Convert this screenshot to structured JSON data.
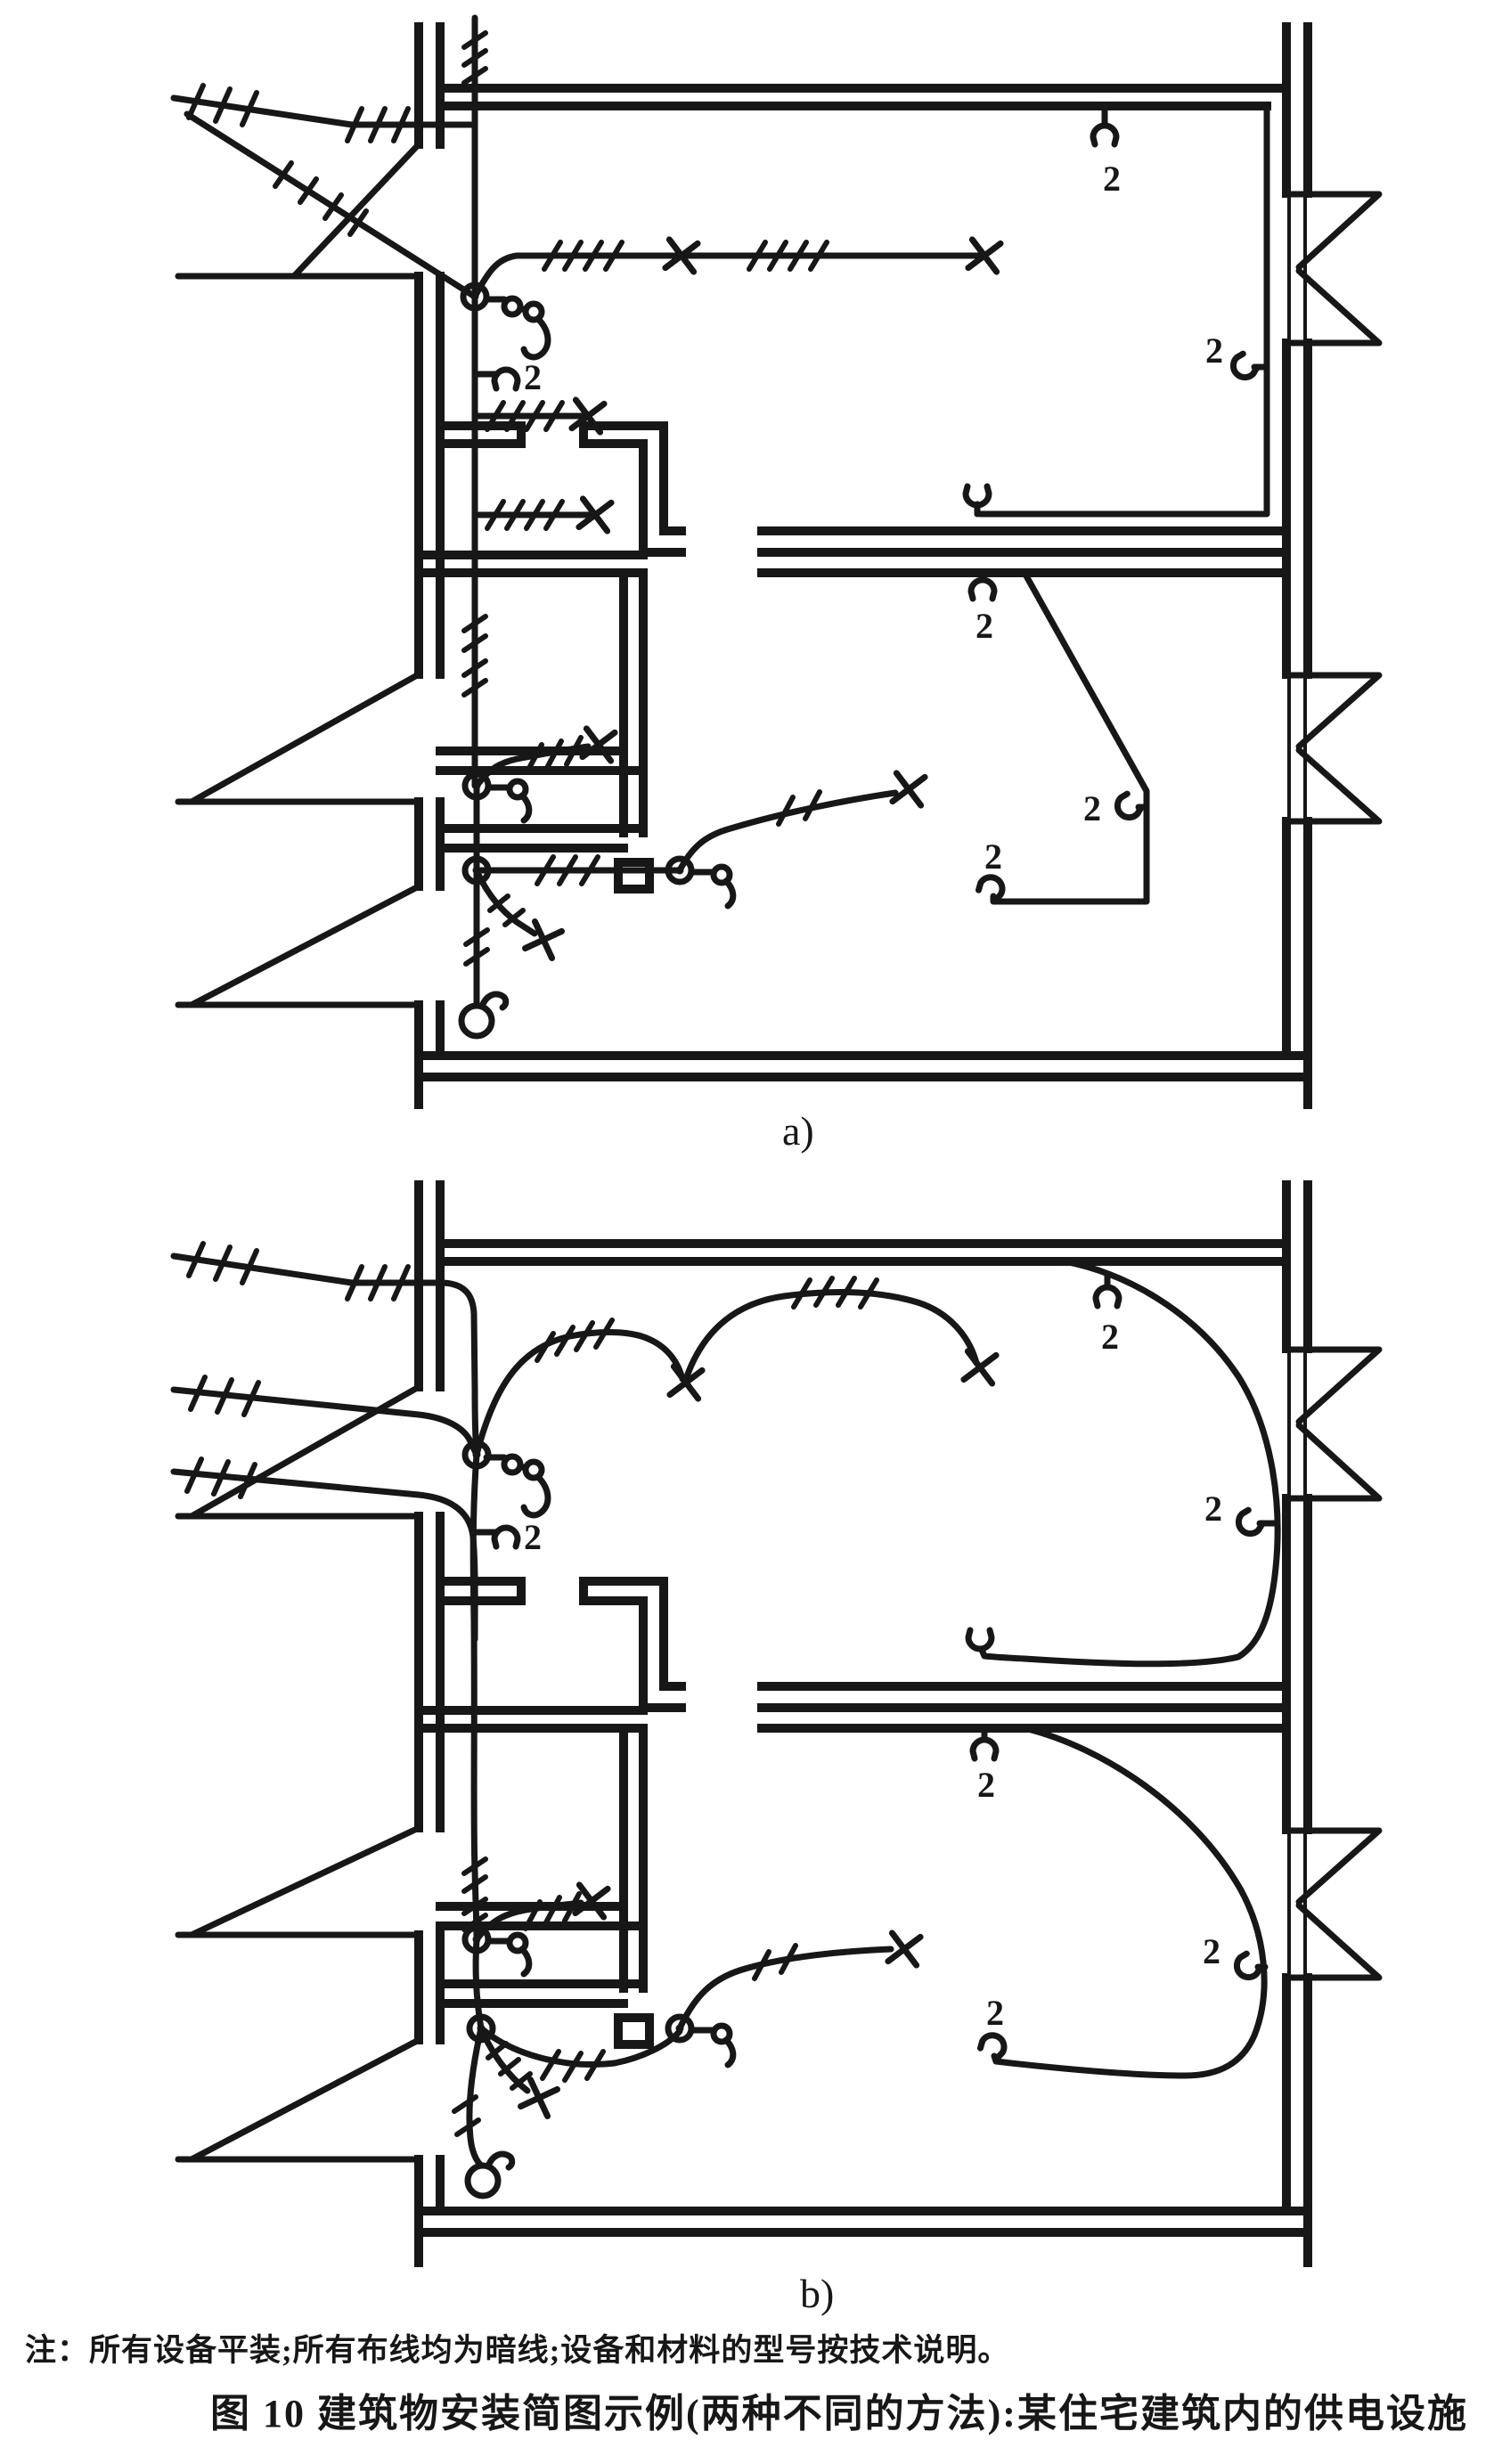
{
  "figure": {
    "sub_label_a": "a)",
    "sub_label_b": "b)",
    "note": "注：所有设备平装;所有布线均为暗线;设备和材料的型号按技术说明。",
    "caption": "图 10  建筑物安装简图示例(两种不同的方法):某住宅建筑内的供电设施"
  },
  "annotations": {
    "socket_count_labels": [
      {
        "id": "a-entry-socket",
        "text": "2"
      },
      {
        "id": "a-room1-top-right-socket",
        "text": "2"
      },
      {
        "id": "a-room1-right-wall-socket",
        "text": "2"
      },
      {
        "id": "a-room2-top-socket",
        "text": "2"
      },
      {
        "id": "a-room2-right-wall-socket",
        "text": "2"
      },
      {
        "id": "a-room2-end-socket",
        "text": "2"
      },
      {
        "id": "b-entry-socket",
        "text": "2"
      },
      {
        "id": "b-room1-top-right-socket",
        "text": "2"
      },
      {
        "id": "b-room1-right-wall-socket",
        "text": "2"
      },
      {
        "id": "b-room2-top-socket",
        "text": "2"
      },
      {
        "id": "b-room2-right-wall-socket",
        "text": "2"
      },
      {
        "id": "b-room2-end-socket",
        "text": "2"
      }
    ]
  },
  "symbols": {
    "ceiling-lamp-icon": "x-cross",
    "pendant-lamp-icon": "open-circle-with-hook",
    "junction-box-icon": "circle-with-dot",
    "switch-icon": "circle-with-curved-lever",
    "socket-outlet-icon": "half-circle-cup",
    "window-icon": "triangle-flag",
    "conductor-count-tick": "slash-group"
  },
  "colors": {
    "ink": "#171717",
    "paper": "#ffffff"
  }
}
